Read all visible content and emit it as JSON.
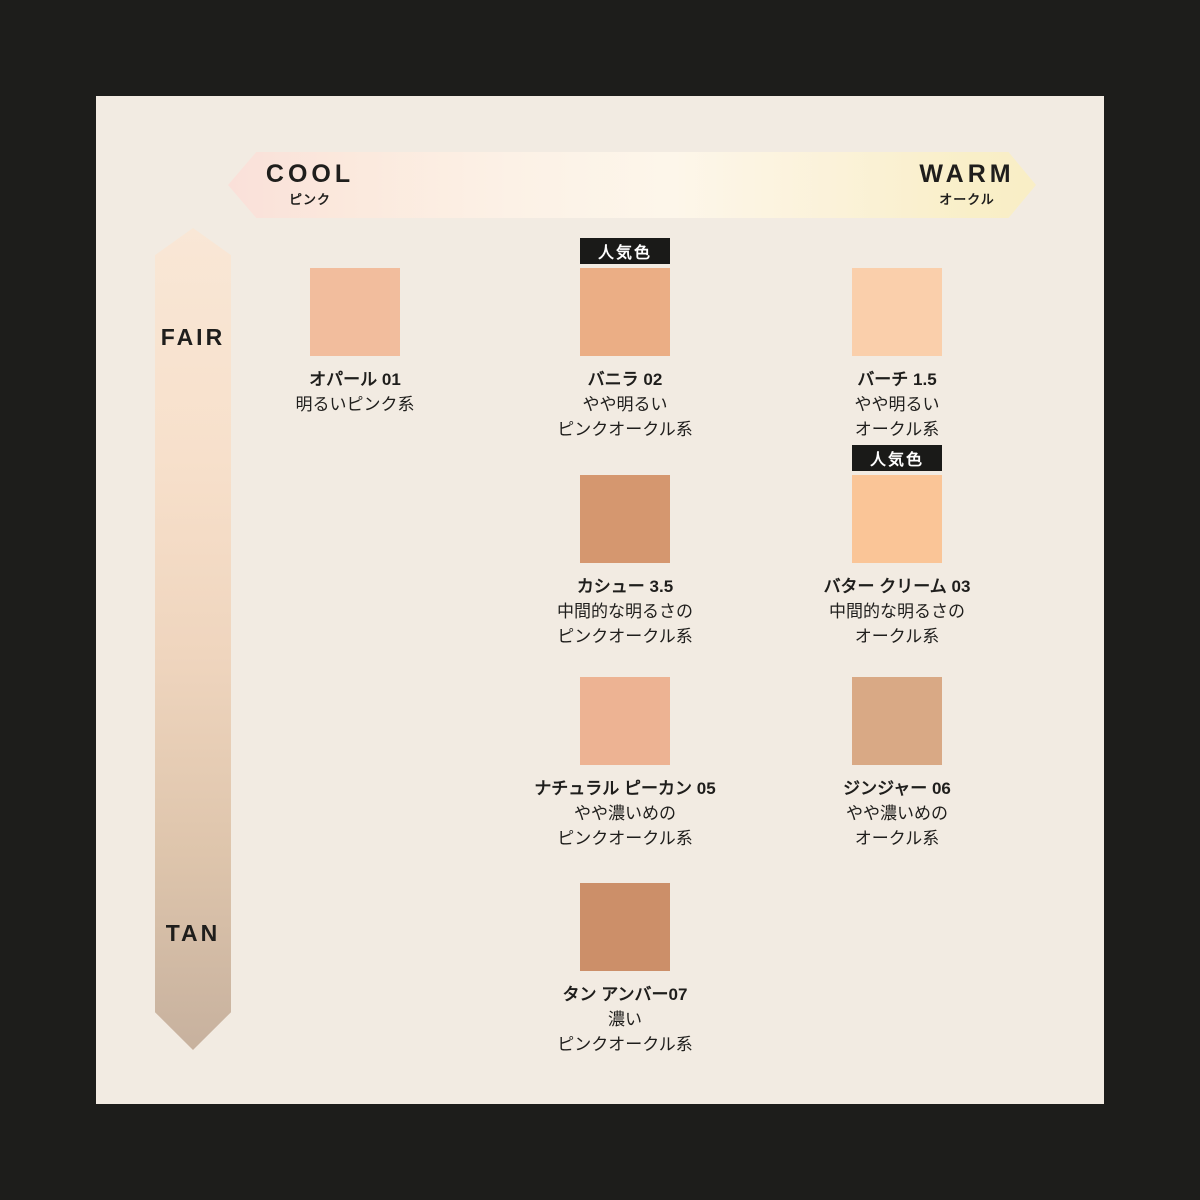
{
  "page": {
    "background": "#1D1D1B",
    "panel_background": "#F2EBE2",
    "text_color": "#1F1E1C"
  },
  "horizontal_axis": {
    "left_label": "COOL",
    "left_sublabel": "ピンク",
    "right_label": "WARM",
    "right_sublabel": "オークル",
    "gradient": [
      "#FAE0D9",
      "#FCF1E6",
      "#FDF6EA",
      "#F9EEC6"
    ]
  },
  "vertical_axis": {
    "top_label": "FAIR",
    "bottom_label": "TAN",
    "gradient": [
      "#F9E7D6",
      "#EFD5BE",
      "#C7B19E"
    ]
  },
  "popular_badge_label": "人気色",
  "shades": [
    {
      "name": "オパール 01",
      "description_lines": [
        "明るいピンク系"
      ],
      "color": "#F2BD9D",
      "popular": false,
      "row": 1,
      "col": 1
    },
    {
      "name": "バニラ 02",
      "description_lines": [
        "やや明るい",
        "ピンクオークル系"
      ],
      "color": "#EBAE85",
      "popular": true,
      "row": 1,
      "col": 2
    },
    {
      "name": "バーチ 1.5",
      "description_lines": [
        "やや明るい",
        "オークル系"
      ],
      "color": "#FACFAB",
      "popular": false,
      "row": 1,
      "col": 3
    },
    {
      "name": "カシュー 3.5",
      "description_lines": [
        "中間的な明るさの",
        "ピンクオークル系"
      ],
      "color": "#D5976F",
      "popular": false,
      "row": 2,
      "col": 2
    },
    {
      "name": "バター クリーム 03",
      "description_lines": [
        "中間的な明るさの",
        "オークル系"
      ],
      "color": "#FAC597",
      "popular": true,
      "row": 2,
      "col": 3
    },
    {
      "name": "ナチュラル ピーカン 05",
      "description_lines": [
        "やや濃いめの",
        "ピンクオークル系"
      ],
      "color": "#EDB393",
      "popular": false,
      "row": 3,
      "col": 2
    },
    {
      "name": "ジンジャー 06",
      "description_lines": [
        "やや濃いめの",
        "オークル系"
      ],
      "color": "#D9A985",
      "popular": false,
      "row": 3,
      "col": 3
    },
    {
      "name": "タン アンバー07",
      "description_lines": [
        "濃い",
        "ピンクオークル系"
      ],
      "color": "#CC8F69",
      "popular": false,
      "row": 4,
      "col": 2
    }
  ]
}
